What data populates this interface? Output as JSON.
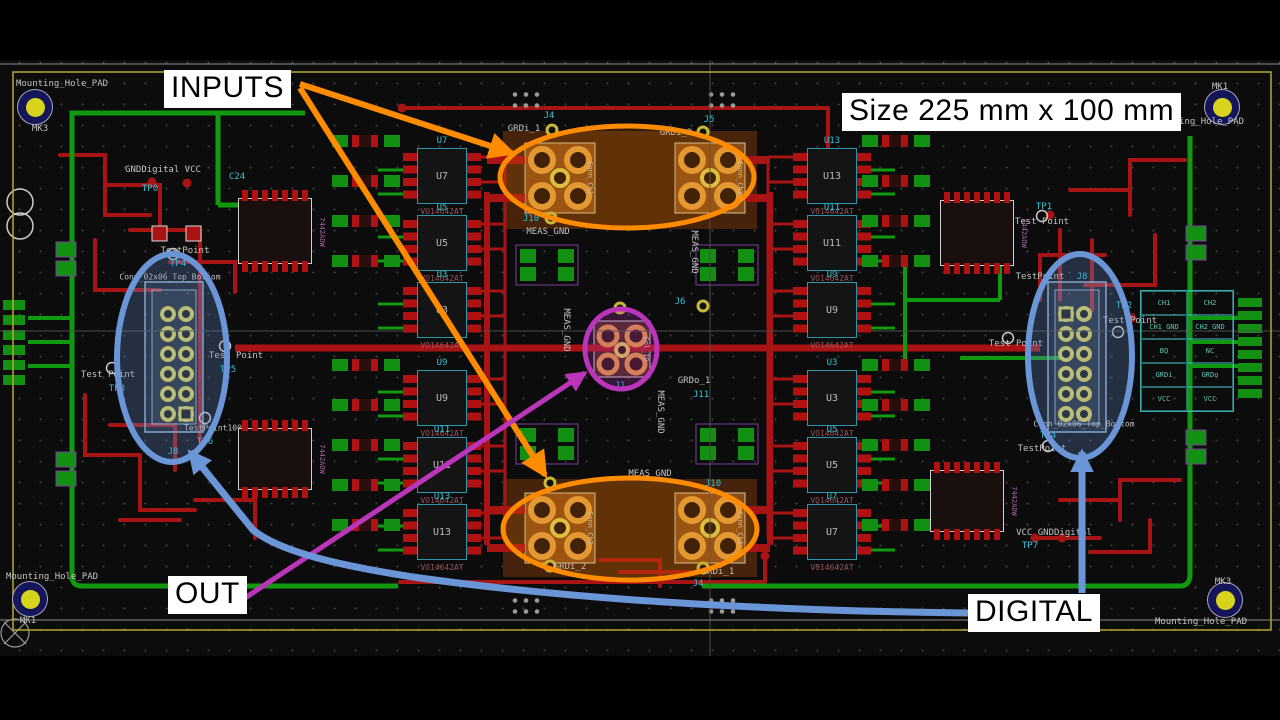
{
  "annotations": {
    "inputs": "INPUTS",
    "out": "OUT",
    "digital": "DIGITAL",
    "size_note": "Size 225 mm x 100 mm"
  },
  "highlight_colors": {
    "inputs_arrows": "#ff8c00",
    "out_arrow": "#bb35bb",
    "digital_arrows": "#6a96d8"
  },
  "board": {
    "outline_color": "#b8a832",
    "mounting_holes": [
      {
        "ref": "MK3",
        "name": "Mounting_Hole_PAD",
        "x": 35,
        "y": 107,
        "name_x": 62,
        "name_y": 84,
        "ref_x": 40,
        "ref_y": 129
      },
      {
        "ref": "MK1",
        "name": "Mounting_Hole_PAD",
        "x": 1222,
        "y": 107,
        "name_x": 1198,
        "name_y": 122,
        "ref_x": 1220,
        "ref_y": 87
      },
      {
        "ref": "MK1",
        "name": "Mounting_Hole_PAD",
        "x": 30,
        "y": 599,
        "name_x": 52,
        "name_y": 577,
        "ref_x": 28,
        "ref_y": 621
      },
      {
        "ref": "MK3",
        "name": "Mounting_Hole_PAD",
        "x": 1225,
        "y": 600,
        "name_x": 1201,
        "name_y": 622,
        "ref_x": 1223,
        "ref_y": 582
      }
    ]
  },
  "ics": {
    "part": "VO14642AT",
    "left": [
      {
        "ref": "U7",
        "y": 148
      },
      {
        "ref": "U5",
        "y": 215
      },
      {
        "ref": "U3",
        "y": 282
      },
      {
        "ref": "U9",
        "y": 370
      },
      {
        "ref": "U11",
        "y": 437
      },
      {
        "ref": "U13",
        "y": 504
      }
    ],
    "right": [
      {
        "ref": "U13",
        "y": 148
      },
      {
        "ref": "U11",
        "y": 215
      },
      {
        "ref": "U9",
        "y": 282
      },
      {
        "ref": "U3",
        "y": 370
      },
      {
        "ref": "U5",
        "y": 437
      },
      {
        "ref": "U7",
        "y": 504
      }
    ]
  },
  "pin_table": {
    "rows": [
      [
        "CH1",
        "CH2"
      ],
      [
        "CH1_GND",
        "CH2_GND"
      ],
      [
        "BQ",
        "NC"
      ],
      [
        "GRDi",
        "GRDo"
      ],
      [
        "VCC",
        "VCC"
      ]
    ]
  },
  "silk_labels": [
    {
      "t": "GNDDigital VCC",
      "x": 163,
      "y": 170,
      "c": "w"
    },
    {
      "t": "TP0",
      "x": 150,
      "y": 189,
      "c": "c"
    },
    {
      "t": "C24",
      "x": 237,
      "y": 177,
      "c": "c"
    },
    {
      "t": "GRDi_1",
      "x": 524,
      "y": 129,
      "c": "w"
    },
    {
      "t": "J4",
      "x": 549,
      "y": 116,
      "c": "c"
    },
    {
      "t": "GRDi_2",
      "x": 676,
      "y": 133,
      "c": "w"
    },
    {
      "t": "J5",
      "x": 709,
      "y": 120,
      "c": "c"
    },
    {
      "t": "J10",
      "x": 531,
      "y": 219,
      "c": "c"
    },
    {
      "t": "MEAS_GND",
      "x": 548,
      "y": 232,
      "c": "w"
    },
    {
      "t": "MEAS_GND",
      "x": 694,
      "y": 252,
      "c": "w",
      "rot": 90
    },
    {
      "t": "J6",
      "x": 680,
      "y": 302,
      "c": "c"
    },
    {
      "t": "MEAS_GND",
      "x": 566,
      "y": 330,
      "c": "w",
      "rot": 90
    },
    {
      "t": "Col_ID",
      "x": 646,
      "y": 349,
      "c": "w",
      "rot": 90,
      "fs": 7
    },
    {
      "t": "J1",
      "x": 620,
      "y": 386,
      "c": "c"
    },
    {
      "t": "GRDo_1",
      "x": 694,
      "y": 381,
      "c": "w"
    },
    {
      "t": "J11",
      "x": 701,
      "y": 395,
      "c": "c"
    },
    {
      "t": "MEAS_GND",
      "x": 660,
      "y": 412,
      "c": "w",
      "rot": 90
    },
    {
      "t": "MEAS_GND",
      "x": 650,
      "y": 474,
      "c": "w"
    },
    {
      "t": "J10",
      "x": 713,
      "y": 484,
      "c": "c"
    },
    {
      "t": "GRDi_2",
      "x": 570,
      "y": 567,
      "c": "w"
    },
    {
      "t": "GRDi_1",
      "x": 718,
      "y": 572,
      "c": "w"
    },
    {
      "t": "J4",
      "x": 698,
      "y": 584,
      "c": "c"
    },
    {
      "t": "Conn_02x06_Top_Bottom",
      "x": 170,
      "y": 277,
      "c": "w",
      "fs": 8
    },
    {
      "t": "TestPoint",
      "x": 185,
      "y": 251,
      "c": "w"
    },
    {
      "t": "TP4",
      "x": 178,
      "y": 264,
      "c": "c"
    },
    {
      "t": "Test Point",
      "x": 236,
      "y": 356,
      "c": "w"
    },
    {
      "t": "TP5",
      "x": 228,
      "y": 370,
      "c": "c"
    },
    {
      "t": "Test Point",
      "x": 108,
      "y": 375,
      "c": "w"
    },
    {
      "t": "TP3",
      "x": 117,
      "y": 389,
      "c": "c"
    },
    {
      "t": "TestPoint100",
      "x": 213,
      "y": 428,
      "c": "w",
      "fs": 8
    },
    {
      "t": "TP6",
      "x": 205,
      "y": 442,
      "c": "c"
    },
    {
      "t": "J8",
      "x": 173,
      "y": 452,
      "c": "c"
    },
    {
      "t": "TestPoint",
      "x": 1040,
      "y": 277,
      "c": "w"
    },
    {
      "t": "J8",
      "x": 1082,
      "y": 277,
      "c": "c"
    },
    {
      "t": "TP2",
      "x": 1124,
      "y": 306,
      "c": "c"
    },
    {
      "t": "Test Point",
      "x": 1130,
      "y": 321,
      "c": "w"
    },
    {
      "t": "Test Point",
      "x": 1016,
      "y": 344,
      "c": "w"
    },
    {
      "t": "TP4",
      "x": 1048,
      "y": 436,
      "c": "c"
    },
    {
      "t": "TestPoint",
      "x": 1042,
      "y": 449,
      "c": "w"
    },
    {
      "t": "Conn_02x06_Top_Bottom",
      "x": 1084,
      "y": 424,
      "c": "w",
      "fs": 8
    },
    {
      "t": "TP1",
      "x": 1044,
      "y": 207,
      "c": "c"
    },
    {
      "t": "Test Point",
      "x": 1042,
      "y": 222,
      "c": "w"
    },
    {
      "t": "VCC GNDDigital",
      "x": 1054,
      "y": 533,
      "c": "w"
    },
    {
      "t": "TP7",
      "x": 1030,
      "y": 546,
      "c": "c"
    },
    {
      "t": "7442ADW",
      "x": 322,
      "y": 232,
      "c": "p",
      "rot": 90,
      "fs": 7
    },
    {
      "t": "7442ADW",
      "x": 322,
      "y": 459,
      "c": "p",
      "rot": 90,
      "fs": 7
    },
    {
      "t": "7442ADW",
      "x": 1024,
      "y": 233,
      "c": "p",
      "rot": 90,
      "fs": 7
    },
    {
      "t": "7442ADW",
      "x": 1014,
      "y": 501,
      "c": "p",
      "rot": 90,
      "fs": 7
    },
    {
      "t": "Conn_Ch1",
      "x": 590,
      "y": 178,
      "c": "w",
      "rot": 90,
      "fs": 7
    },
    {
      "t": "Conn_Ch2",
      "x": 740,
      "y": 178,
      "c": "w",
      "rot": 90,
      "fs": 7
    },
    {
      "t": "Conn_Ch2",
      "x": 590,
      "y": 528,
      "c": "w",
      "rot": 90,
      "fs": 7
    },
    {
      "t": "Conn_Ch1",
      "x": 740,
      "y": 528,
      "c": "w",
      "rot": 90,
      "fs": 7
    },
    {
      "t": "160r",
      "x": 366,
      "y": 141,
      "c": "w",
      "fs": 7
    },
    {
      "t": "20r",
      "x": 366,
      "y": 181,
      "c": "w",
      "fs": 7
    },
    {
      "t": "10F",
      "x": 366,
      "y": 221,
      "c": "w",
      "fs": 7
    },
    {
      "t": "160r",
      "x": 366,
      "y": 261,
      "c": "w",
      "fs": 7
    },
    {
      "t": "20r",
      "x": 366,
      "y": 365,
      "c": "w",
      "fs": 7
    },
    {
      "t": "160r",
      "x": 366,
      "y": 405,
      "c": "w",
      "fs": 7
    },
    {
      "t": "10F",
      "x": 366,
      "y": 445,
      "c": "w",
      "fs": 7
    },
    {
      "t": "20r",
      "x": 366,
      "y": 485,
      "c": "w",
      "fs": 7
    },
    {
      "t": "160r",
      "x": 366,
      "y": 525,
      "c": "w",
      "fs": 7
    },
    {
      "t": "160r",
      "x": 898,
      "y": 141,
      "c": "w",
      "fs": 7
    },
    {
      "t": "20r",
      "x": 898,
      "y": 181,
      "c": "w",
      "fs": 7
    },
    {
      "t": "10F",
      "x": 898,
      "y": 221,
      "c": "w",
      "fs": 7
    },
    {
      "t": "160r",
      "x": 898,
      "y": 261,
      "c": "w",
      "fs": 7
    },
    {
      "t": "20r",
      "x": 898,
      "y": 365,
      "c": "w",
      "fs": 7
    },
    {
      "t": "160r",
      "x": 898,
      "y": 405,
      "c": "w",
      "fs": 7
    },
    {
      "t": "10F",
      "x": 898,
      "y": 445,
      "c": "w",
      "fs": 7
    },
    {
      "t": "20r",
      "x": 898,
      "y": 485,
      "c": "w",
      "fs": 7
    },
    {
      "t": "160r",
      "x": 898,
      "y": 525,
      "c": "w",
      "fs": 7
    }
  ]
}
